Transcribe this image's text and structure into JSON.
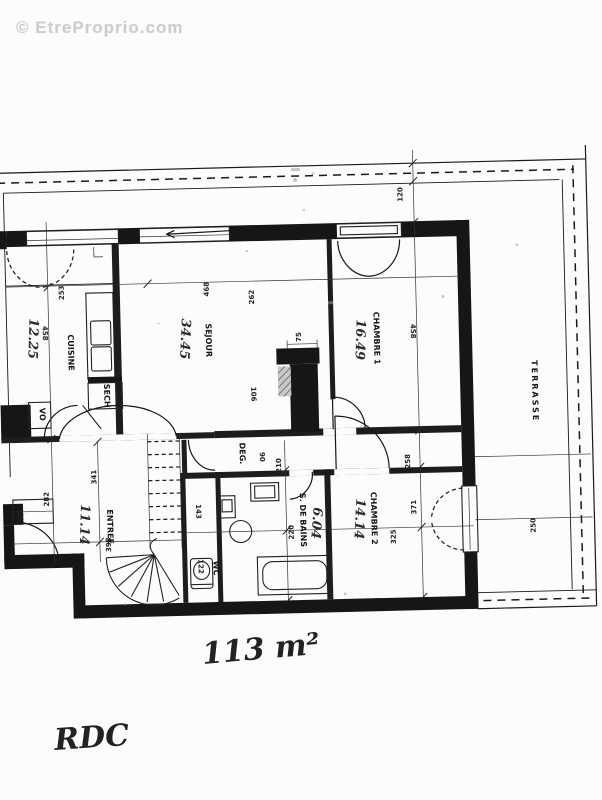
{
  "watermark": {
    "text": "© EtreProprio.com"
  },
  "floor_plan": {
    "rooms": [
      {
        "label": "CUISINE",
        "area": "12.25"
      },
      {
        "label": "SEJOUR",
        "area": "34.45"
      },
      {
        "label": "CHAMBRE 1",
        "area": "16.49"
      },
      {
        "label": "CHAMBRE 2",
        "area": "14.14"
      },
      {
        "label": "ENTREE",
        "area": "11.14"
      },
      {
        "label": "WC"
      },
      {
        "label": "S. DE BAINS",
        "area": "6.04"
      },
      {
        "label": "DEG."
      },
      {
        "label": "SECH"
      },
      {
        "label": "VO"
      },
      {
        "label": "TERRASSE"
      }
    ],
    "dimensions_cm": [
      "120",
      "253",
      "458",
      "468",
      "262",
      "75",
      "458",
      "106",
      "90",
      "210",
      "341",
      "282",
      "55",
      "398",
      "143",
      "122",
      "220",
      "258",
      "371",
      "325",
      "250"
    ],
    "annotations": {
      "total_area": "113 m²",
      "floor_label": "RDC"
    },
    "colors": {
      "ink": "#1a1a1a",
      "paper": "#fcfcfa",
      "watermark_gray": "#cdcdcd"
    }
  }
}
